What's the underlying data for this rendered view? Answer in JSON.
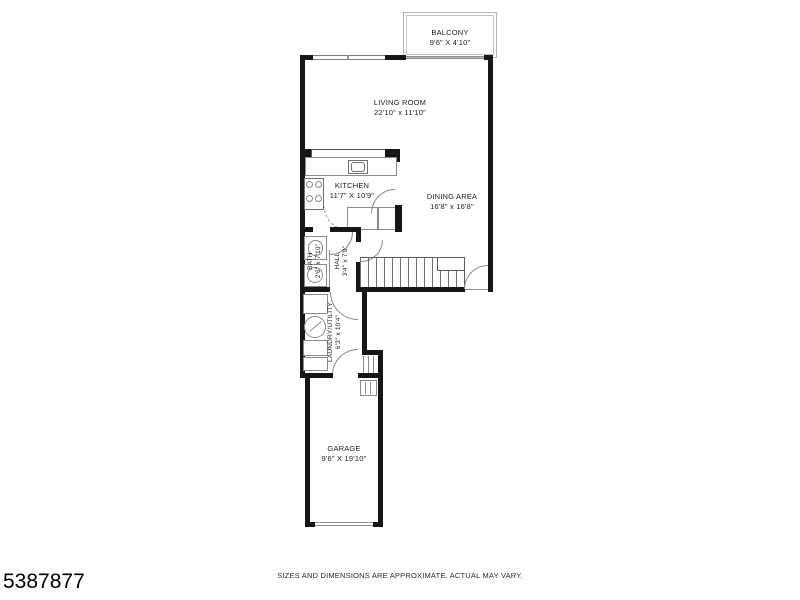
{
  "rooms": {
    "balcony": {
      "name": "BALCONY",
      "dims": "9'6\" X 4'10\""
    },
    "living_room": {
      "name": "LIVING ROOM",
      "dims": "22'10\" x 11'10\""
    },
    "kitchen": {
      "name": "KITCHEN",
      "dims": "11'7\" X 10'9\""
    },
    "dining_area": {
      "name": "DINING AREA",
      "dims": "16'8\" x 16'8\""
    },
    "bath": {
      "name": "BATH",
      "dims": "2'6\" x 7'10\""
    },
    "hall": {
      "name": "HALL",
      "dims": "3'4\" x 7'9\""
    },
    "laundry": {
      "name": "LAUNDRY/UTILITY",
      "dims": "6'3\" x 10'4\""
    },
    "garage": {
      "name": "GARAGE",
      "dims": "9'6\" X 19'10\""
    }
  },
  "footer": {
    "disclaimer": "SIZES AND DIMENSIONS ARE APPROXIMATE. ACTUAL MAY VARY.",
    "listing_id": "5387877"
  },
  "colors": {
    "wall": "#161616",
    "fixture_line": "#8a8a8a"
  }
}
